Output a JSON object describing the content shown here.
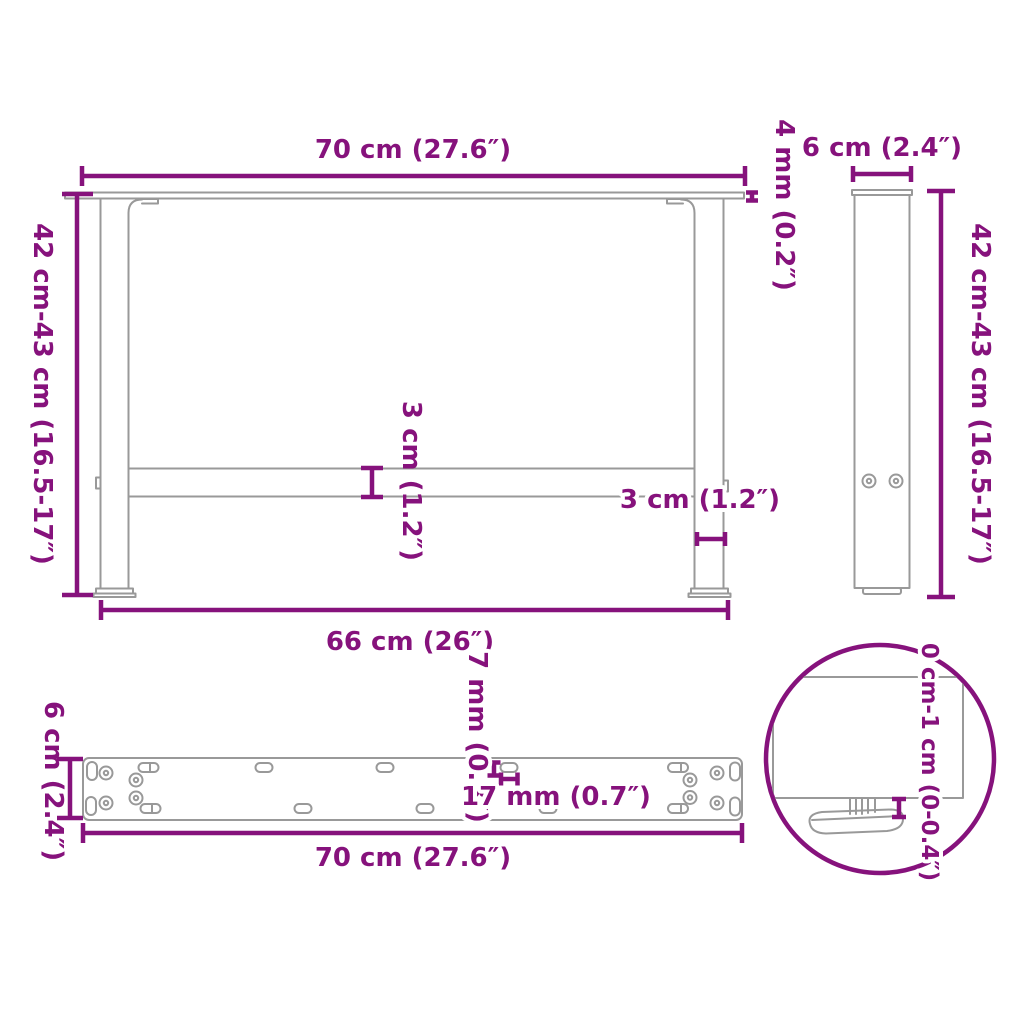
{
  "colors": {
    "dimension_accent": "#86127C",
    "line_art": "#999999",
    "background": "#FFFFFF"
  },
  "views": {
    "front": {
      "top_width": "70 cm (27.6″)",
      "height_range": "42 cm-43 cm (16.5-17″)",
      "top_bar_thickness": "4 mm (0.2″)",
      "crossbar_height": "3 cm (1.2″)",
      "leg_width": "3 cm (1.2″)",
      "feet_span": "66 cm (26″)"
    },
    "side": {
      "depth": "6 cm (2.4″)",
      "height_range": "42 cm-43 cm (16.5-17″)"
    },
    "mounting_plate": {
      "length": "70 cm (27.6″)",
      "depth": "6 cm (2.4″)",
      "slot_height": "7 mm (0.3″)",
      "slot_length": "17 mm (0.7″)"
    },
    "foot_detail": {
      "adjustable_range": "0 cm-1 cm (0-0.4″)"
    }
  }
}
